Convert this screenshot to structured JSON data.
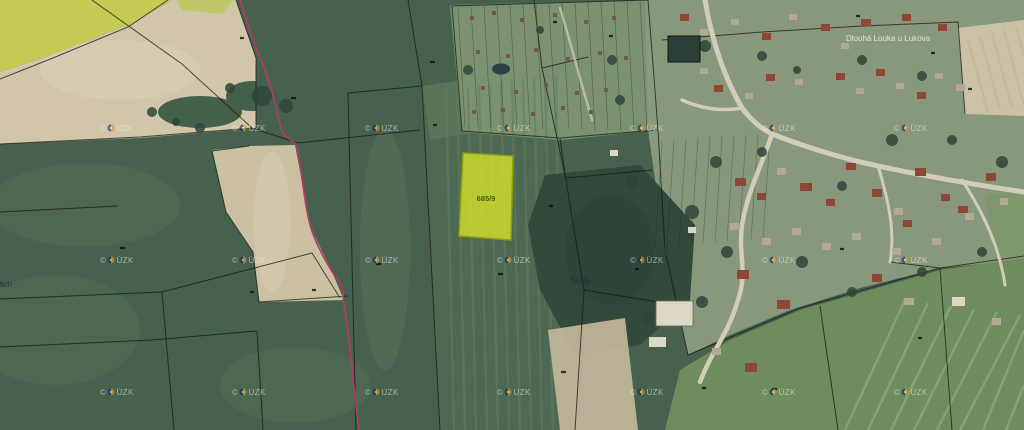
{
  "map": {
    "labels": {
      "highlighted_parcel_number": "685/9",
      "place_name_center": "Skála",
      "place_name_left_clipped": "lavrách",
      "cadastre_area_name": "Dlouhá Louka u Lukova"
    },
    "watermark": {
      "full_text": "© ČÚZK",
      "copyright_sign": "©",
      "org_suffix": "ÚZK"
    },
    "colors": {
      "highlight_fill": "#d7e42a",
      "highlight_stroke": "#8fa00d",
      "route_line": "#b23a67",
      "boundary_line": "#191910",
      "field_green": "#47614f",
      "field_beige": "#d1c6aa",
      "field_yellow": "#c3cb52",
      "road": "#d2ccba",
      "watermark_text": "#edeee8"
    }
  }
}
